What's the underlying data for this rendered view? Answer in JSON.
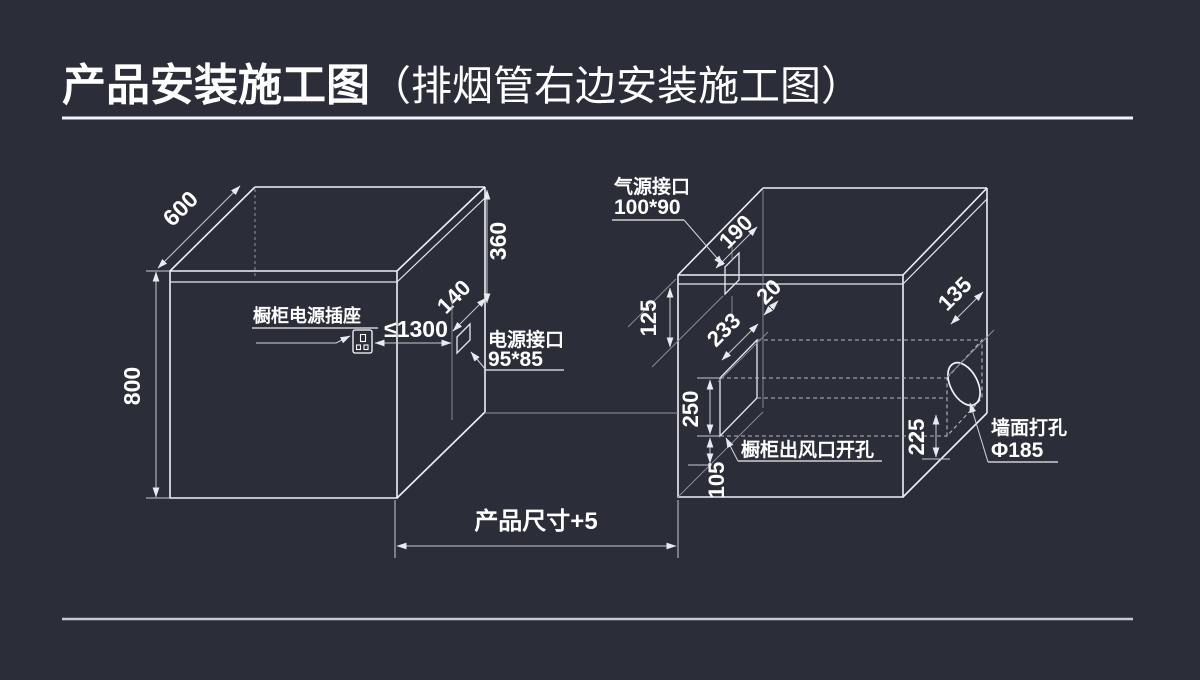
{
  "title": {
    "main": "产品安装施工图",
    "paren": "（排烟管右边安装施工图）"
  },
  "colors": {
    "background": "#2b2e38",
    "line": "#eef0f4",
    "dimension_line": "#c7cad2",
    "text": "#ffffff"
  },
  "left_cabinet": {
    "dim_top_depth": "600",
    "dim_height": "800",
    "dim_right_upper": "360",
    "dim_port_offset": "140",
    "dim_socket_distance": "≤1300",
    "socket_label": "橱柜电源插座",
    "power_port_label": "电源接口",
    "power_port_size": "95*85"
  },
  "right_cabinet": {
    "gas_port_label": "气源接口",
    "gas_port_size": "100*90",
    "dim_gas_offset": "190",
    "dim_gas_depth": "125",
    "dim_duct_depth": "233",
    "dim_duct_gap": "20",
    "dim_duct_height": "250",
    "dim_duct_bottom": "105",
    "dim_hole_bottom": "225",
    "dim_hole_depth": "135",
    "outlet_label": "橱柜出风口开孔",
    "wall_hole_label": "墙面打孔",
    "wall_hole_size": "Φ185"
  },
  "bottom": {
    "product_dim": "产品尺寸+5"
  }
}
